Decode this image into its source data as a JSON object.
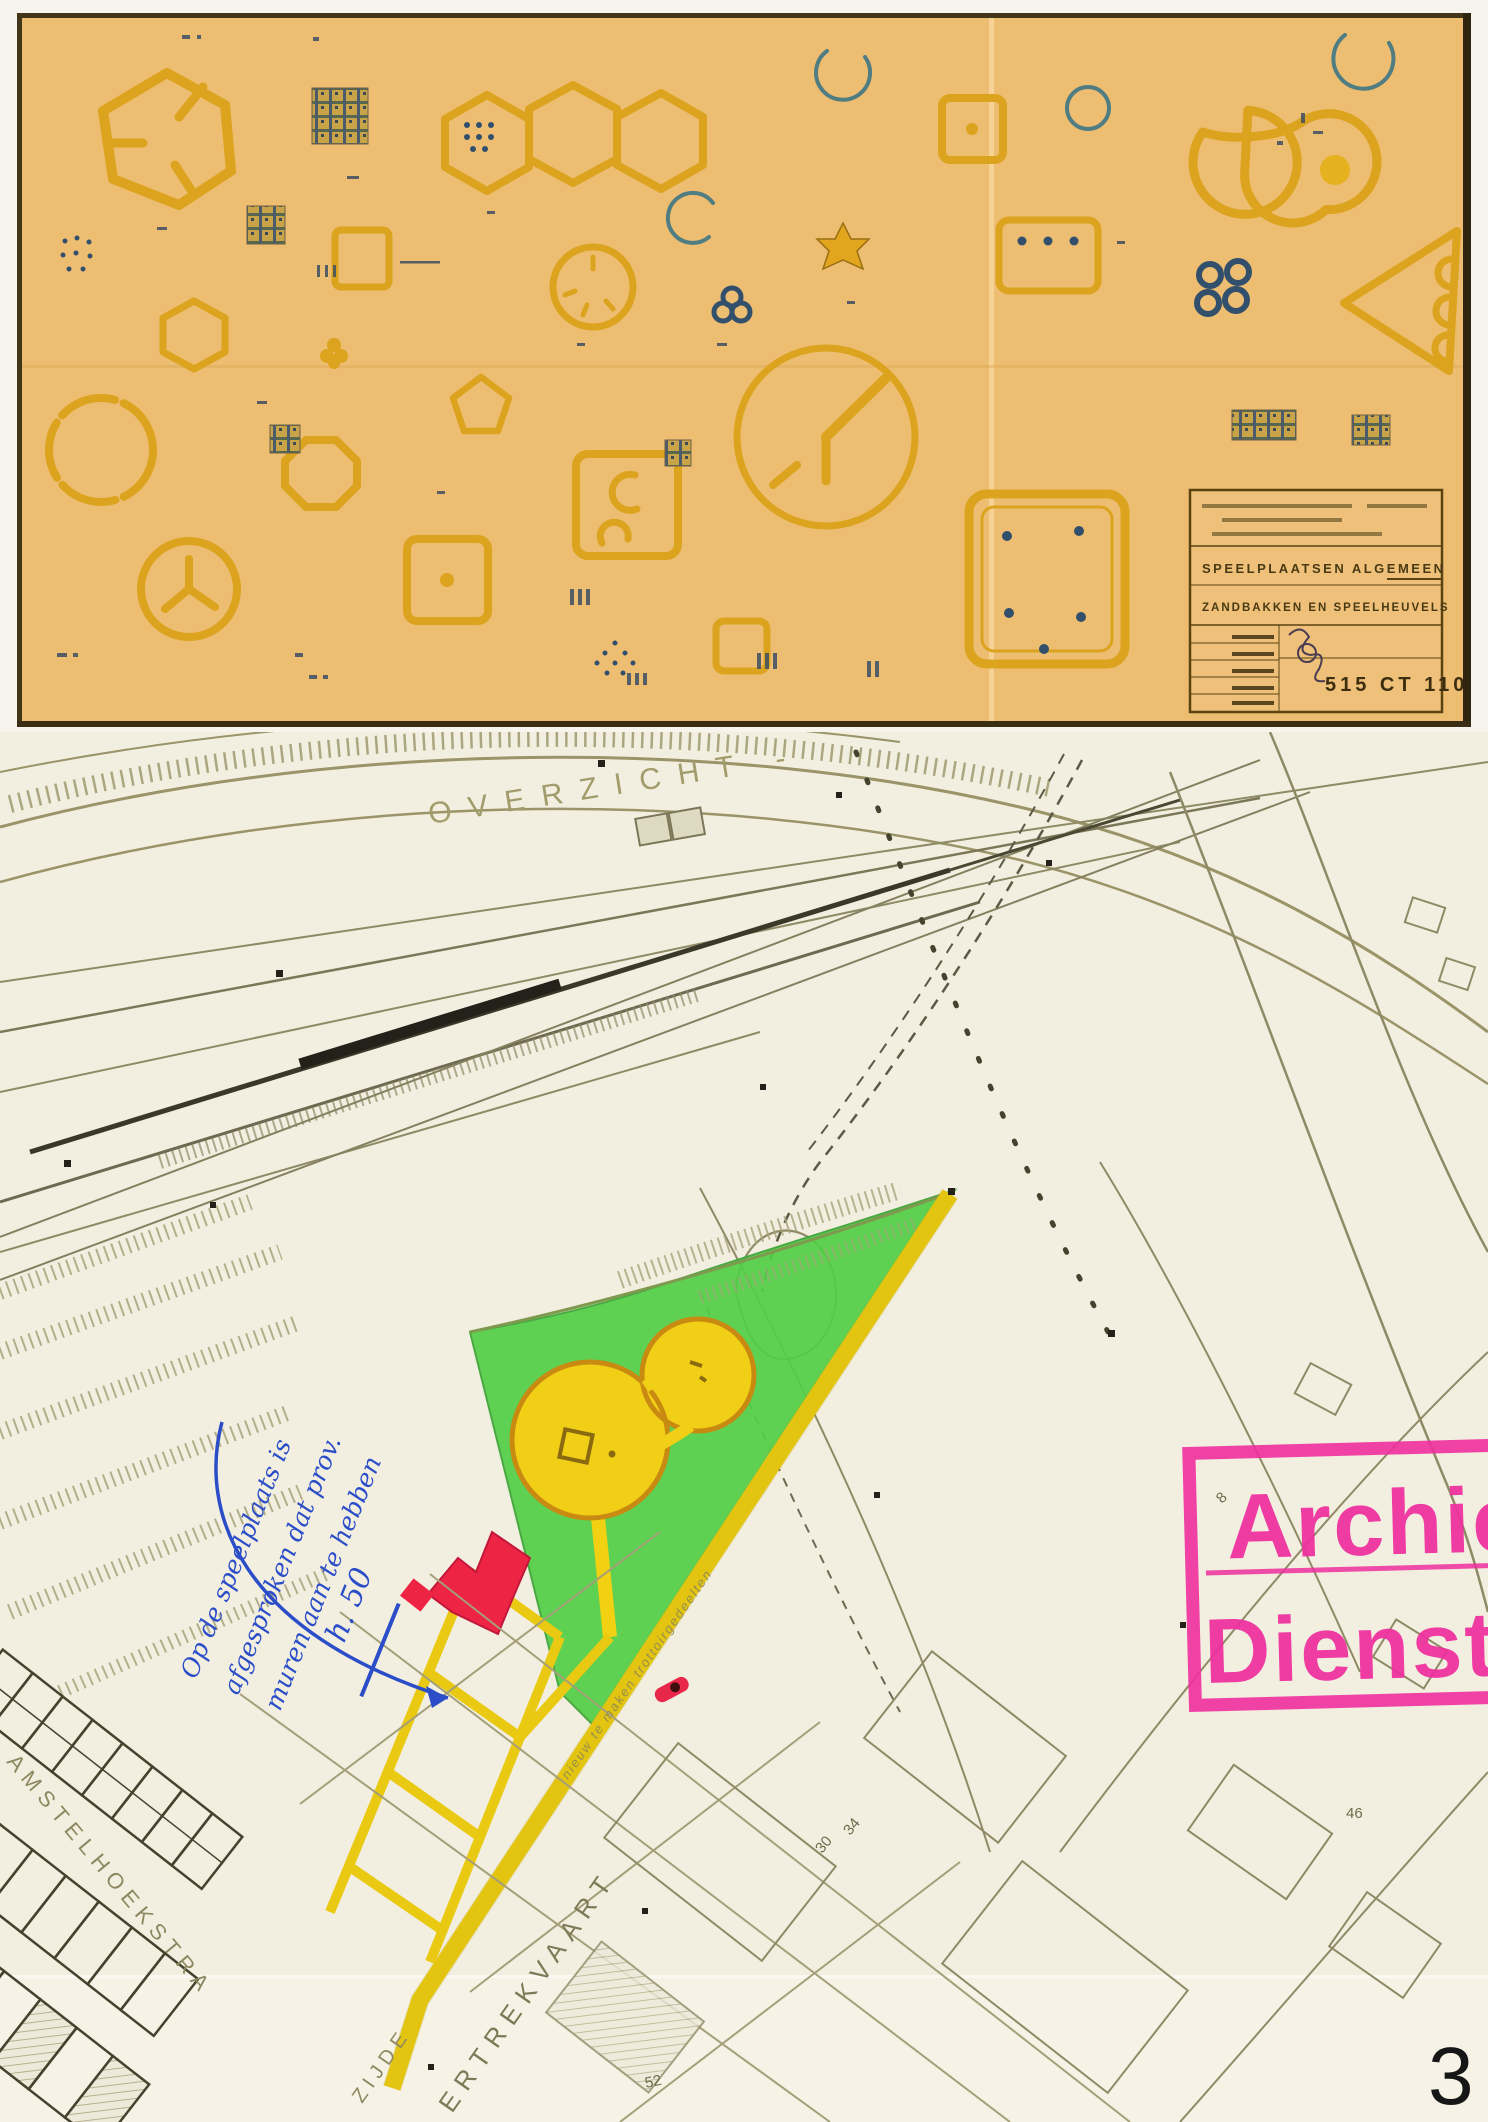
{
  "page": {
    "number": "3"
  },
  "sheet": {
    "colors": {
      "paper": "#edbd72",
      "ink": "#dca31e",
      "ink_dark": "#8a5f10",
      "navy": "#32506b",
      "frame": "#42351a"
    },
    "title_block": {
      "title_line1": "SPEELPLAATSEN ALGEMEEN",
      "title_line2": "ZANDBAKKEN EN SPEELHEUVELS",
      "drawing_number": "515 CT 110"
    }
  },
  "map": {
    "colors": {
      "paper": "#f3efe0",
      "park_green": "#52cf47",
      "path_yellow": "#f2d012",
      "building_red": "#ee2445",
      "ink_blue": "#2b4ec8",
      "stamp_magenta": "#ef2f9f",
      "line_olive": "#8f8a66"
    },
    "labels": {
      "top": "OVERZICHT -",
      "street_left": "AMSTELHOEKSTRA",
      "canal": "ERTREKVAART",
      "quay_fragment": "ZIJDE",
      "path_note": "nieuw te maken trottoirgedeelten"
    },
    "plot_numbers": {
      "n8": "8",
      "n30": "30",
      "n34": "34",
      "n46": "46",
      "n52": "52"
    },
    "handwriting": {
      "line1": "Op de speelplaats is",
      "line2": "afgesproken dat prov.",
      "line3": "muren aan te hebben",
      "measure": "h. 50"
    },
    "stamp": {
      "line1": "Archie",
      "line2": "Dienst P."
    }
  }
}
